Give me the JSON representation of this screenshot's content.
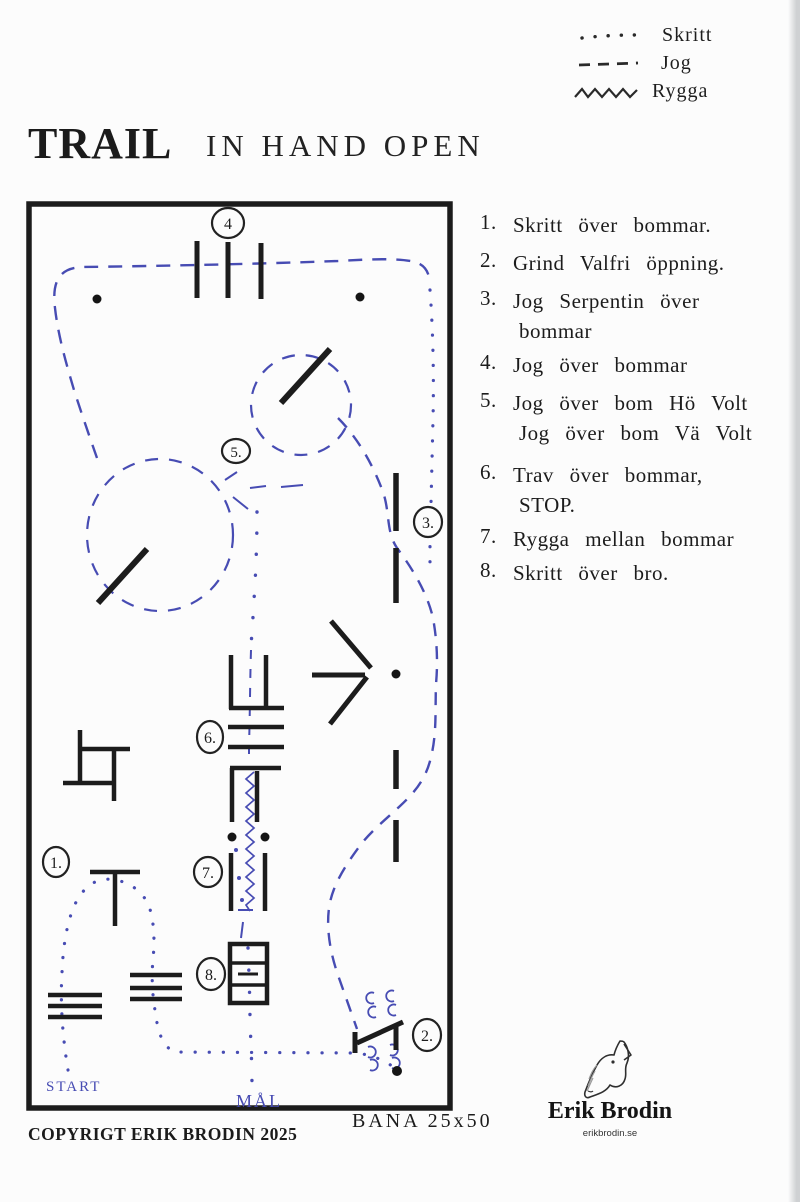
{
  "legend": {
    "items": [
      {
        "symbol": "dotted-line",
        "label": "Skritt"
      },
      {
        "symbol": "dashed-line",
        "label": "Jog"
      },
      {
        "symbol": "zigzag-line",
        "label": "Rygga"
      }
    ]
  },
  "title": {
    "printed": "TRAIL",
    "handwritten": "IN HAND OPEN"
  },
  "course_list": {
    "items": [
      {
        "number": "1.",
        "lines": [
          "Skritt över bommar."
        ]
      },
      {
        "number": "2.",
        "lines": [
          "Grind Valfri öppning."
        ]
      },
      {
        "number": "3.",
        "lines": [
          "Jog Serpentin över",
          "bommar"
        ]
      },
      {
        "number": "4.",
        "lines": [
          "Jog över bommar"
        ]
      },
      {
        "number": "5.",
        "lines": [
          "Jog över bom Hö Volt",
          "Jog över bom Vä Volt"
        ]
      },
      {
        "number": "6.",
        "lines": [
          "Trav över bommar,",
          "STOP."
        ]
      },
      {
        "number": "7.",
        "lines": [
          "Rygga mellan bommar"
        ]
      },
      {
        "number": "8.",
        "lines": [
          "Skritt över bro."
        ]
      }
    ]
  },
  "arena": {
    "markers": [
      {
        "label": "1."
      },
      {
        "label": "2."
      },
      {
        "label": "3."
      },
      {
        "label": "4"
      },
      {
        "label": "5."
      },
      {
        "label": "6."
      },
      {
        "label": "7."
      },
      {
        "label": "8."
      }
    ],
    "start_label": "START",
    "goal_label": "MÅL"
  },
  "footer": {
    "copyright": "COPYRIGT ERIK BRODIN 2025",
    "arena_size": "BANA 25x50"
  },
  "logo": {
    "name": "Erik Brodin",
    "website": "erikbrodin.se"
  },
  "colors": {
    "ink": "#1d1d1d",
    "pen_blue": "#474cb3",
    "paper": "#fcfcfc"
  }
}
